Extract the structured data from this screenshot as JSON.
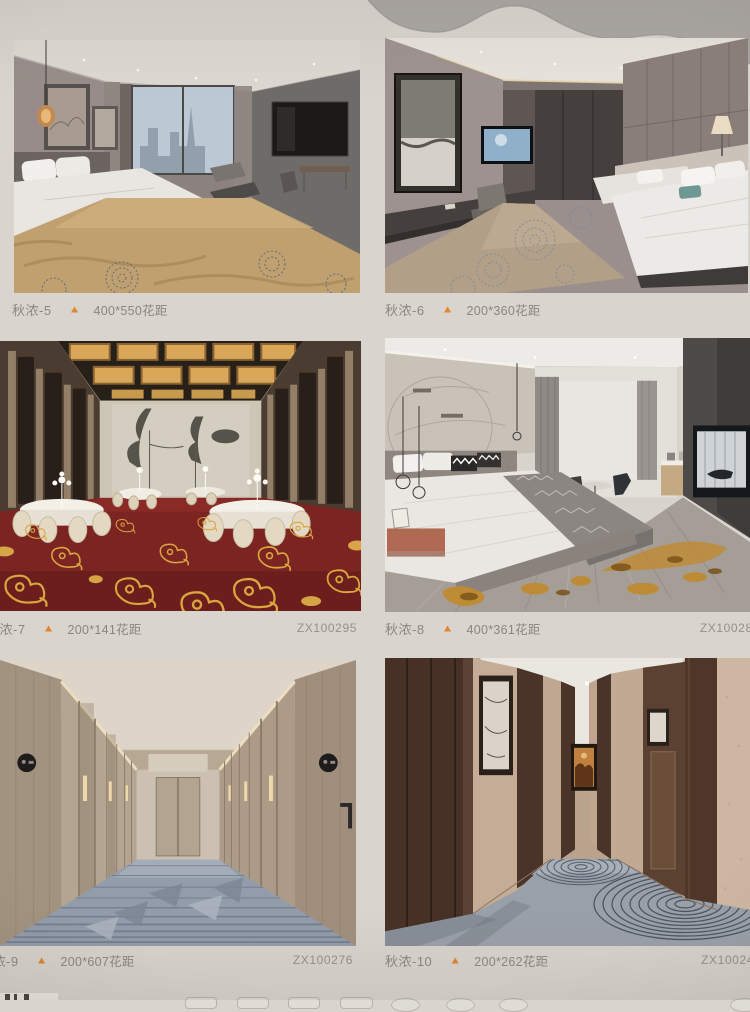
{
  "page": {
    "background_color": "#d9d4ce",
    "kind": "carpet-catalog-page"
  },
  "icons": {
    "triangle": "▲",
    "triangle_color": "#e0862c"
  },
  "products": [
    {
      "label": "秋浓-5",
      "spec": "400*550花距",
      "code": "",
      "image": "hotel-bedroom-city-window-tan-carpet"
    },
    {
      "label": "秋浓-6",
      "spec": "200*360花距",
      "code": "",
      "image": "twin-bedroom-floral-carpet"
    },
    {
      "label": "秋浓-7",
      "spec": "200*141花距",
      "code": "ZX100295",
      "image": "banquet-hall-red-gold-cloud-carpet"
    },
    {
      "label": "秋浓-8",
      "spec": "400*361花距",
      "code": "ZX100284",
      "image": "modern-bedroom-gold-splash-floor"
    },
    {
      "label": "秋浓-9",
      "spec": "200*607花距",
      "code": "ZX100276",
      "image": "corridor-striped-blue-gray-carpet"
    },
    {
      "label": "秋浓-10",
      "spec": "200*262花距",
      "code": "ZX10024",
      "image": "corridor-ripple-circle-carpet"
    }
  ],
  "colors": {
    "caption_text": "#8b8680",
    "code_text": "#95908a",
    "red_carpet": "#7b2422",
    "gold_pattern": "#d9a63f",
    "tan_carpet": "#c0a06e",
    "corridor_carpet": "#939cab"
  }
}
